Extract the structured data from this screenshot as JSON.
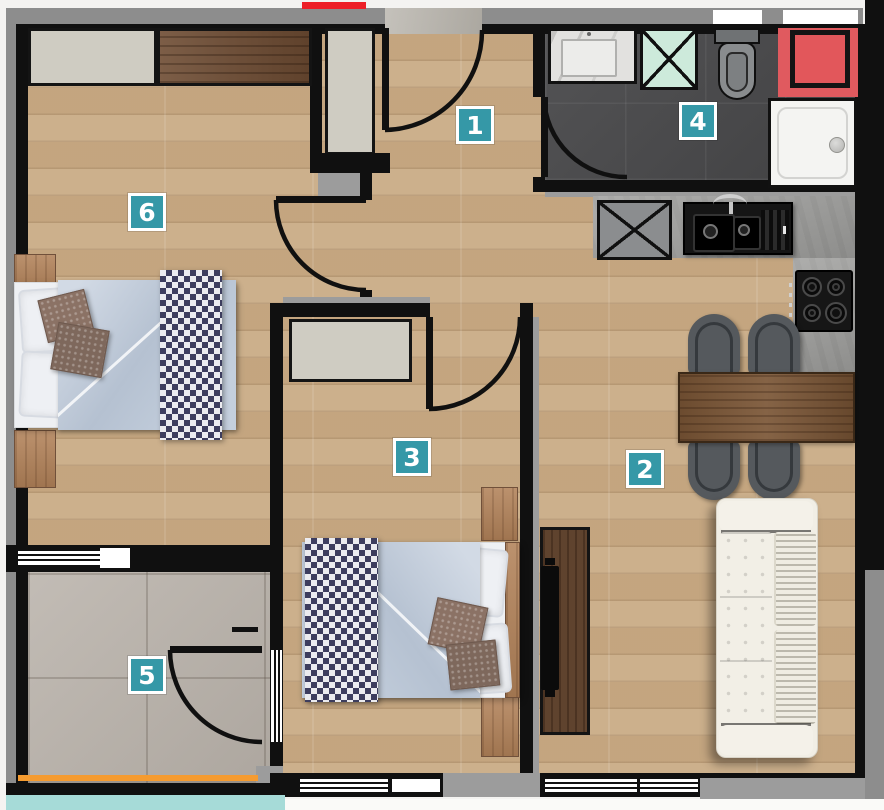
{
  "floor_plan": {
    "room_labels": {
      "label_1": "1",
      "label_2": "2",
      "label_3": "3",
      "label_4": "4",
      "label_5": "5",
      "label_6": "6"
    },
    "label_style": {
      "background": "#3598a7",
      "border": "#ffffff",
      "text": "#ffffff"
    },
    "palette": {
      "wall": "#101010",
      "exterior_band": "#8d8d8d",
      "wood_floor": "#c9ab85",
      "bathroom_floor": "#4a4a4c",
      "balcony_floor": "#b8b1a9",
      "kitchen_counter": "#9e9e9c",
      "accent_red_box": "#e2575b",
      "entrance_red_bar": "#ed1f27",
      "balcony_rail_orange": "#f59b30",
      "balcony_strip_teal": "#a6dbd8",
      "shaft_mint": "#cdeadb",
      "sofa_white": "#f1eee5",
      "bed_duvet_blue": "#bcc7d5",
      "bed_throw_navy": "#3d3d5e"
    },
    "furniture": [
      "double-bed",
      "single-bed",
      "wardrobe",
      "hall-closet",
      "nightstand",
      "checkered-throw",
      "sofa",
      "tv-unit",
      "dining-table",
      "dining-chair",
      "kitchen-sink",
      "gas-hob",
      "kitchen-counter",
      "washbasin",
      "toilet",
      "shower-tray",
      "ventilation-shaft",
      "entrance-door",
      "balcony-door"
    ]
  }
}
